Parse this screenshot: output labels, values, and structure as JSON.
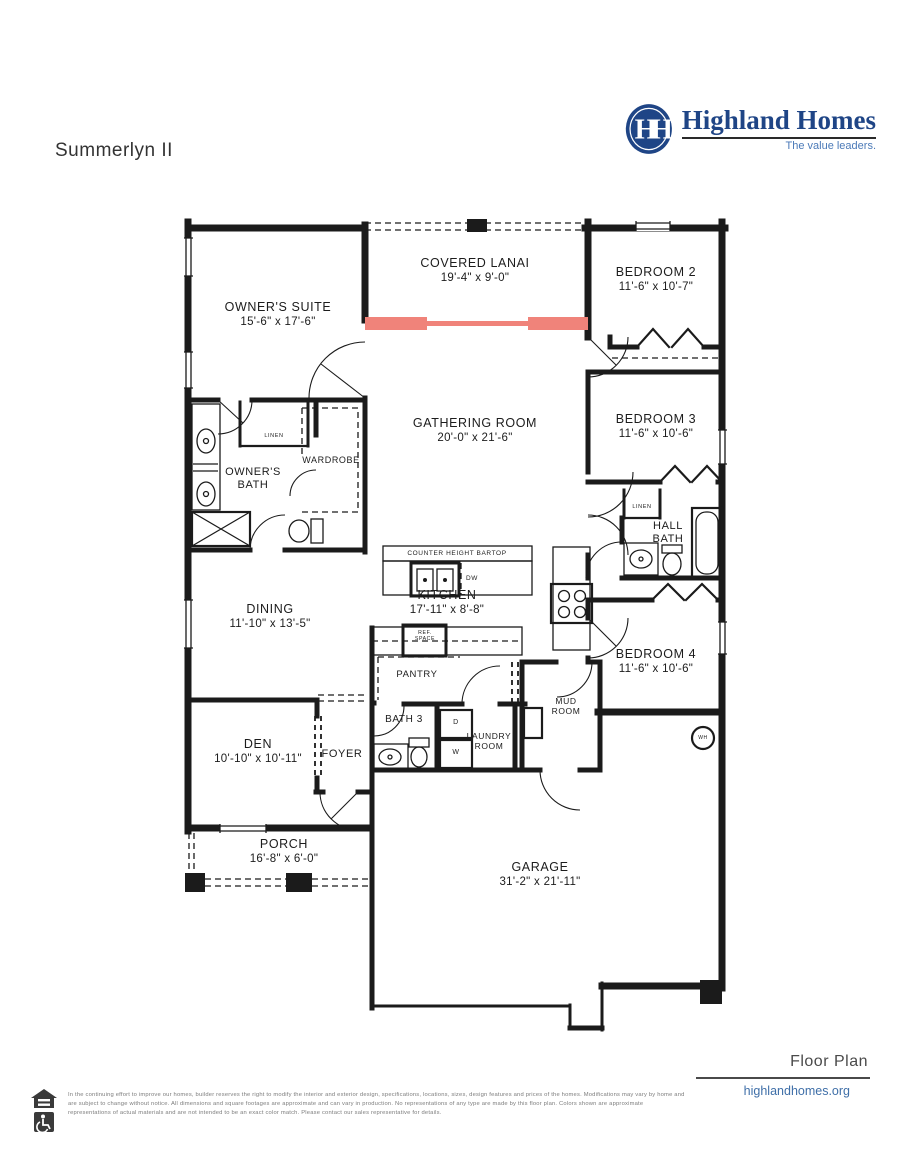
{
  "page": {
    "title": "Summerlyn II",
    "footer_label": "Floor Plan",
    "website": "highlandhomes.org",
    "disclaimer": "In the continuing effort to improve our homes, builder reserves the right to modify the interior and exterior design, specifications, locations, sizes, design features and prices of the homes. Modifications may vary by home and are subject to change without notice. All dimensions and square footages are approximate and can vary in production. No representations of any type are made by this floor plan. Colors shown are approximate representations of actual materials and are not intended to be an exact color match. Please contact our sales representative for details."
  },
  "logo": {
    "monogram": "HH",
    "name": "Highland Homes",
    "tagline": "The value leaders."
  },
  "colors": {
    "wall": "#1b1b1b",
    "sliding_door": "#F0837A",
    "brand_blue": "#1F4586",
    "link_blue": "#3F6FA8"
  },
  "rooms": {
    "owners_suite": {
      "name": "OWNER'S SUITE",
      "dims": "15'-6\" x 17'-6\""
    },
    "covered_lanai": {
      "name": "COVERED LANAI",
      "dims": "19'-4\" x 9'-0\""
    },
    "bedroom_2": {
      "name": "BEDROOM 2",
      "dims": "11'-6\" x 10'-7\""
    },
    "bedroom_3": {
      "name": "BEDROOM 3",
      "dims": "11'-6\" x 10'-6\""
    },
    "gathering_room": {
      "name": "GATHERING ROOM",
      "dims": "20'-0\" x 21'-6\""
    },
    "owners_bath": {
      "name": "OWNER'S BATH"
    },
    "wardrobe": {
      "name": "WARDROBE"
    },
    "hall_bath": {
      "name": "HALL BATH"
    },
    "kitchen": {
      "name": "KITCHEN",
      "dims": "17'-11\" x 8'-8\""
    },
    "dining": {
      "name": "DINING",
      "dims": "11'-10\" x 13'-5\""
    },
    "bedroom_4": {
      "name": "BEDROOM 4",
      "dims": "11'-6\" x 10'-6\""
    },
    "pantry": {
      "name": "PANTRY"
    },
    "mud_room": {
      "name": "MUD ROOM"
    },
    "bath_3": {
      "name": "BATH 3"
    },
    "laundry_room": {
      "name": "LAUNDRY ROOM"
    },
    "den": {
      "name": "DEN",
      "dims": "10'-10\" x 10'-11\""
    },
    "foyer": {
      "name": "FOYER"
    },
    "porch": {
      "name": "PORCH",
      "dims": "16'-8\" x 6'-0\""
    },
    "garage": {
      "name": "GARAGE",
      "dims": "31'-2\" x 21'-11\""
    }
  },
  "fixtures": {
    "linen_1": "LINEN",
    "linen_2": "LINEN",
    "counter_bartop": "COUNTER HEIGHT BARTOP",
    "dishwasher": "DW",
    "ref_space": "REF. SPACE",
    "dryer": "D",
    "washer": "W",
    "water_heater": "WH"
  }
}
